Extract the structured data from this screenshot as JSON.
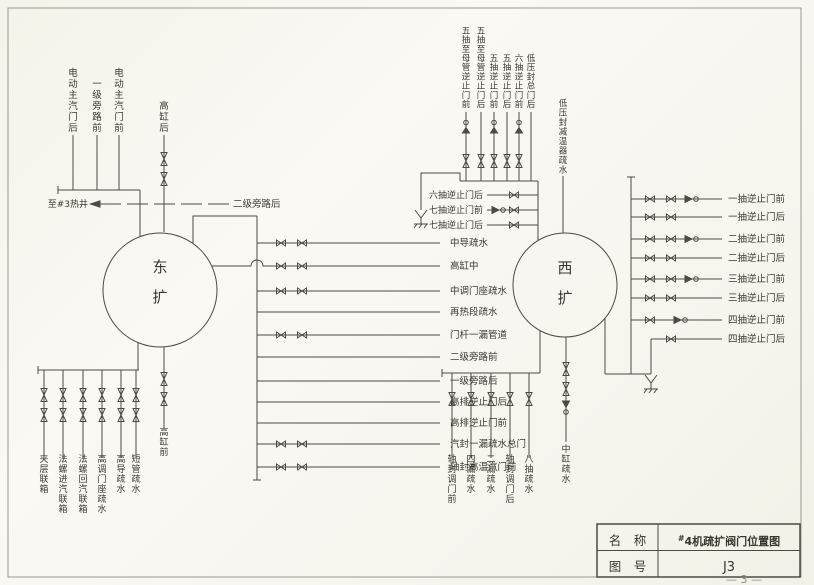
{
  "page": {
    "footer": "— 3 —"
  },
  "colors": {
    "line": "#4c4a43",
    "text": "#3a372e",
    "paper": "#f7f5ee",
    "frame": "#9b988c"
  },
  "title_block": {
    "name_label": "名　称",
    "name_sup": "#",
    "name_main": "4机疏扩阀门位置图",
    "no_label": "图　号",
    "no_value": "J3"
  },
  "east": {
    "circle_label": "东扩",
    "top_labels": [
      "电动主汽门后",
      "一级旁路前",
      "电动主汽门前"
    ],
    "hp_after_label": "高缸后",
    "to_hotwell_label": "至#3热井",
    "bypass2_after_label": "二级旁路后",
    "right_branches": [
      {
        "label": "中导疏水",
        "valves": 2
      },
      {
        "label": "高缸中",
        "valves": 2,
        "from_circle": true
      },
      {
        "label": "中调门座疏水",
        "valves": 2
      },
      {
        "label": "再热段疏水",
        "valves": 0
      },
      {
        "label": "门杆一漏管道",
        "valves": 2
      },
      {
        "label": "二级旁路前",
        "valves": 0
      },
      {
        "label": "一级旁路后",
        "valves": 0
      },
      {
        "label": "高排逆止门后",
        "valves": 0
      },
      {
        "label": "高排逆止门前",
        "valves": 0
      },
      {
        "label": "汽封一漏疏水总门",
        "valves": 2
      },
      {
        "label": "轴封高温汽门前",
        "valves": 2
      }
    ],
    "bottom_labels": [
      "夹层联箱",
      "法螺进汽联箱",
      "法螺回汽联箱",
      "高调门座疏水",
      "高导疏水",
      "短管疏水"
    ],
    "hp_before_label": "高缸前"
  },
  "west": {
    "circle_label": "西扩",
    "top_lines": [
      {
        "label": "五抽至母管逆止门前",
        "check": true
      },
      {
        "label": "五抽至母管逆止门后",
        "check": false
      },
      {
        "label": "五抽逆止门前",
        "check": true
      },
      {
        "label": "五抽逆止门后",
        "check": false
      },
      {
        "label": "六抽逆止门前",
        "check": true
      },
      {
        "label": "低压封总门后",
        "check": false,
        "plain": true
      }
    ],
    "desuperheater_label": "低压封减温器疏水",
    "left_branches": [
      {
        "label": "六抽逆止门后",
        "check": false
      },
      {
        "label": "七抽逆止门前",
        "check": true
      },
      {
        "label": "七抽逆止门后",
        "check": false
      }
    ],
    "right_branches": [
      {
        "label": "一抽逆止门前",
        "bowties": 2,
        "check": true
      },
      {
        "label": "一抽逆止门后",
        "bowties": 2,
        "check": false
      },
      {
        "label": "二抽逆止门前",
        "bowties": 2,
        "check": true
      },
      {
        "label": "二抽逆止门后",
        "bowties": 2,
        "check": false
      },
      {
        "label": "三抽逆止门前",
        "bowties": 2,
        "check": true
      },
      {
        "label": "三抽逆止门后",
        "bowties": 2,
        "check": false
      },
      {
        "label": "四抽逆止门前",
        "bowties": 1,
        "check": true
      },
      {
        "label": "四抽逆止门后",
        "bowties": 1,
        "check": false,
        "short": true
      }
    ],
    "bottom_labels": [
      "轴封调门前",
      "四漏疏水",
      "二漏疏水",
      "轴封调门后",
      "八抽疏水"
    ],
    "ic_drain_label": "中缸疏水"
  }
}
